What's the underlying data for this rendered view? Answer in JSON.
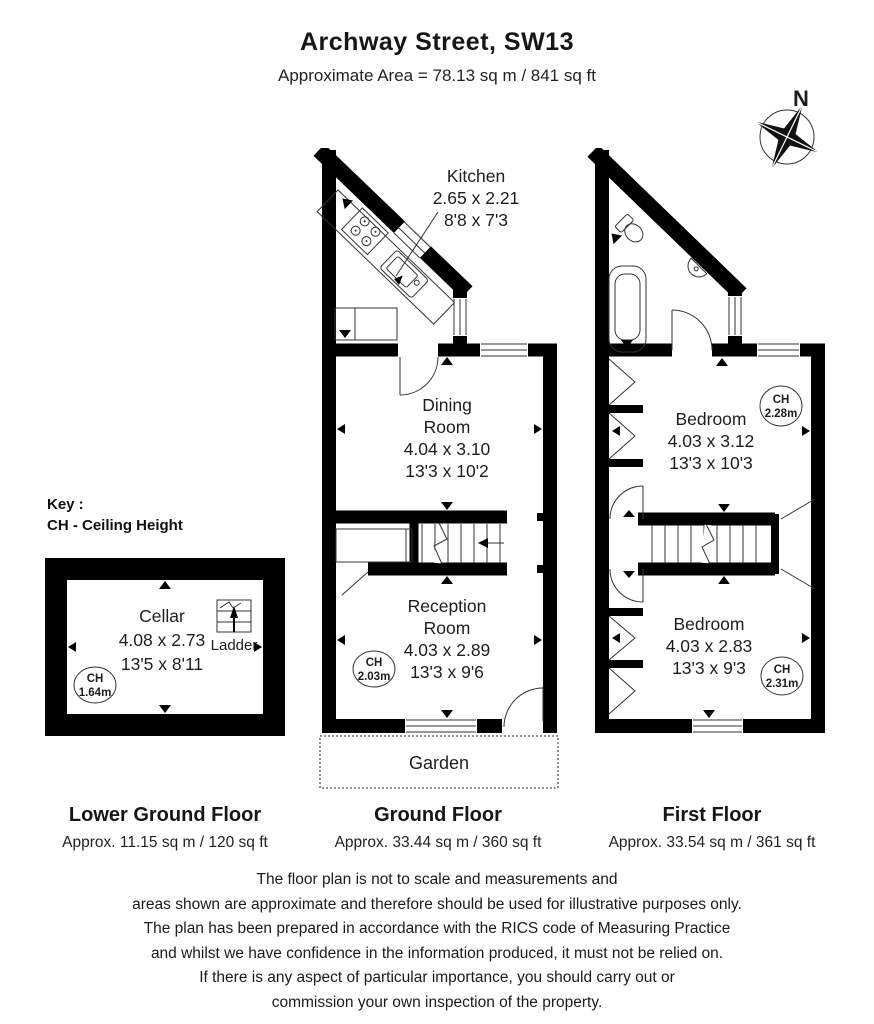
{
  "header": {
    "title": "Archway Street, SW13",
    "subtitle": "Approximate Area = 78.13 sq m / 841 sq ft"
  },
  "compass": {
    "label": "N"
  },
  "key": {
    "line1": "Key :",
    "line2": "CH - Ceiling Height"
  },
  "floors": {
    "lower_ground": {
      "caption": "Lower Ground Floor",
      "area": "Approx. 11.15 sq m / 120 sq ft",
      "cellar": {
        "name": "Cellar",
        "metric": "4.08 x 2.73",
        "imperial": "13'5 x 8'11"
      },
      "ladder_label": "Ladder",
      "ch": {
        "label": "CH",
        "value": "1.64m"
      }
    },
    "ground": {
      "caption": "Ground Floor",
      "area": "Approx. 33.44 sq m / 360 sq ft",
      "kitchen": {
        "name": "Kitchen",
        "metric": "2.65 x 2.21",
        "imperial": "8'8 x 7'3"
      },
      "dining": {
        "name1": "Dining",
        "name2": "Room",
        "metric": "4.04 x 3.10",
        "imperial": "13'3 x 10'2"
      },
      "reception": {
        "name1": "Reception",
        "name2": "Room",
        "metric": "4.03 x 2.89",
        "imperial": "13'3 x 9'6"
      },
      "ch": {
        "label": "CH",
        "value": "2.03m"
      },
      "garden_label": "Garden"
    },
    "first": {
      "caption": "First Floor",
      "area": "Approx. 33.54 sq m / 361 sq ft",
      "bedroom1": {
        "name": "Bedroom",
        "metric": "4.03 x 3.12",
        "imperial": "13'3 x 10'3"
      },
      "bedroom2": {
        "name": "Bedroom",
        "metric": "4.03 x 2.83",
        "imperial": "13'3 x 9'3"
      },
      "ch1": {
        "label": "CH",
        "value": "2.28m"
      },
      "ch2": {
        "label": "CH",
        "value": "2.31m"
      }
    }
  },
  "disclaimer": "The floor plan is not to scale and measurements and\nareas shown are approximate and therefore should be used for illustrative purposes only.\nThe plan has been prepared in accordance with the RICS code of Measuring Practice\nand whilst we have confidence in the information produced, it must not be relied on.\nIf there is any aspect of particular importance, you should carry out or\ncommission your own inspection of the property."
}
